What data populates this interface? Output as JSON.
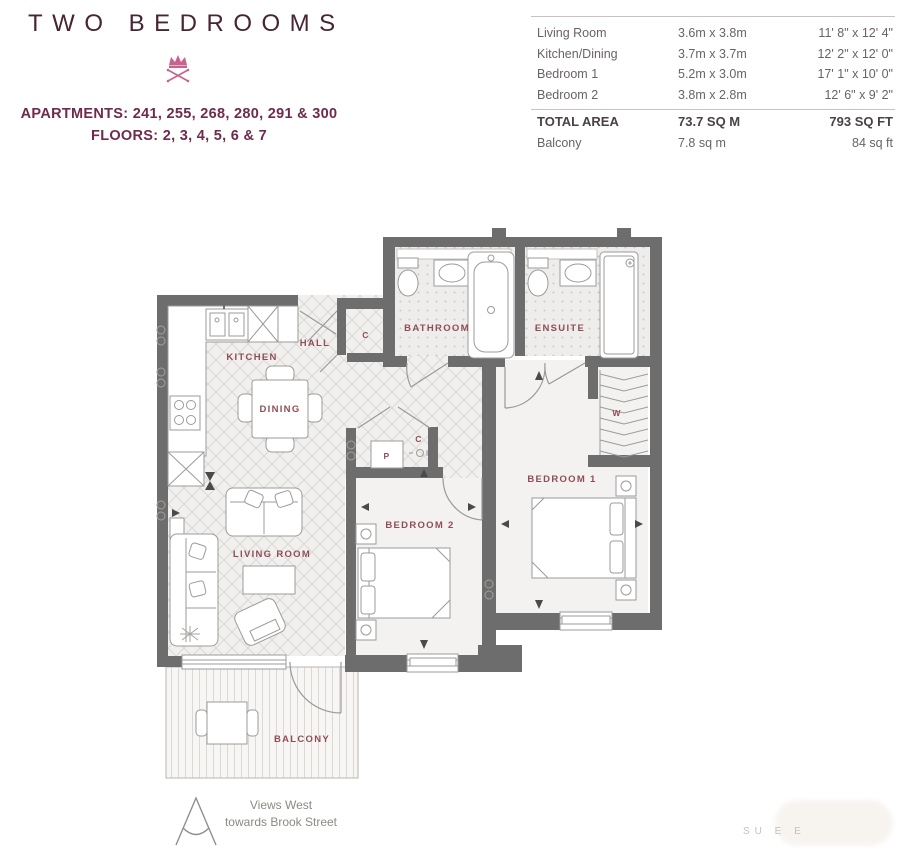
{
  "header": {
    "title": "TWO BEDROOMS",
    "apartments": "APARTMENTS: 241, 255, 268, 280, 291 & 300",
    "floors": "FLOORS: 2, 3, 4, 5, 6 & 7",
    "title_color": "#472634",
    "accent_color": "#6f2a4c",
    "crown_color": "#c9628f"
  },
  "spec_table": {
    "rows": [
      {
        "label": "Living Room",
        "metric": "3.6m x 3.8m",
        "imperial": "11' 8\" x 12' 4\""
      },
      {
        "label": "Kitchen/Dining",
        "metric": "3.7m x 3.7m",
        "imperial": "12' 2\" x 12' 0\""
      },
      {
        "label": "Bedroom 1",
        "metric": "5.2m x 3.0m",
        "imperial": "17' 1\" x 10' 0\""
      },
      {
        "label": "Bedroom 2",
        "metric": "3.8m x 2.8m",
        "imperial": "12' 6\" x 9' 2\""
      }
    ],
    "total_row": {
      "label": "TOTAL AREA",
      "metric": "73.7 SQ M",
      "imperial": "793 SQ FT"
    },
    "balcony_row": {
      "label": "Balcony",
      "metric": "7.8 sq m",
      "imperial": "84 sq ft"
    }
  },
  "floorplan": {
    "wall_color": "#6d6d6d",
    "label_color": "#8f4e57",
    "labels": {
      "kitchen": "KITCHEN",
      "hall": "HALL",
      "dining": "DINING",
      "living_room": "LIVING ROOM",
      "bedroom_1": "BEDROOM 1",
      "bedroom_2": "BEDROOM 2",
      "bathroom": "BATHROOM",
      "ensuite": "ENSUITE",
      "balcony": "BALCONY",
      "cupboard_hall": "C",
      "cupboard_inner": "C",
      "pantry": "P",
      "wardrobe": "W"
    }
  },
  "footer": {
    "compass_line1": "Views West",
    "compass_line2": "towards Brook Street"
  },
  "watermark": {
    "text": "SU  E E"
  }
}
